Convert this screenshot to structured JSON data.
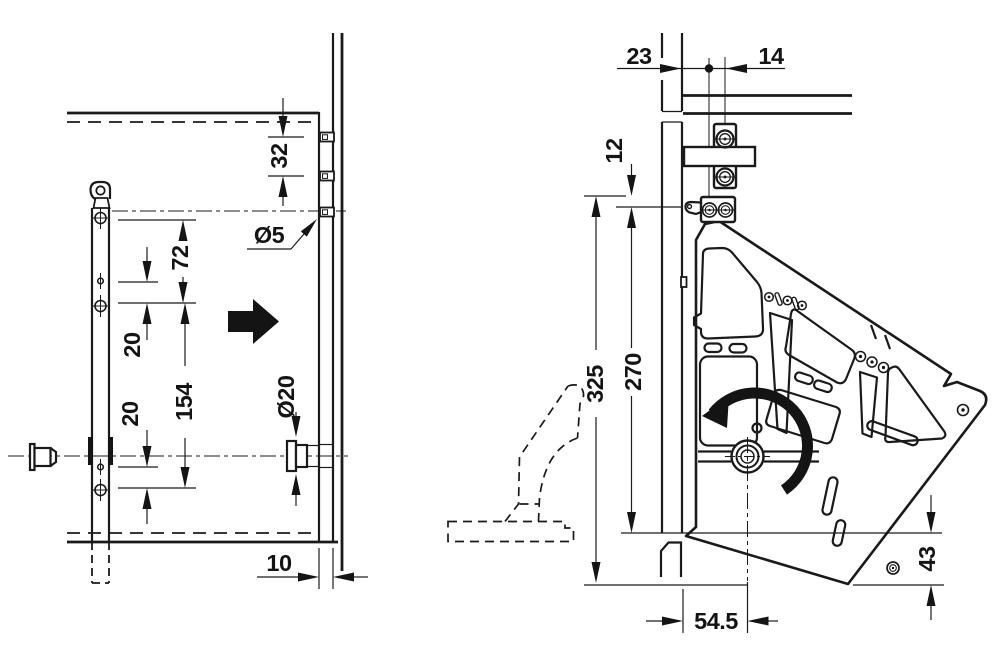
{
  "drawing": {
    "type": "technical-installation-diagram",
    "background": "#ffffff",
    "ink_color": "#1a1a1a",
    "views": {
      "left": {
        "name": "front installation view (mounting rail and drill holes)",
        "dims": {
          "screw_spacing": "32",
          "pilot_hole_dia": "Ø5",
          "hole_top": "72",
          "hole_upper": "20",
          "hole_span": "154",
          "hole_lower": "20",
          "bolt_dia": "Ø20",
          "front_setback": "10"
        }
      },
      "right": {
        "name": "side installation view (pivot lever bracket)",
        "dims": {
          "edge_to_screw": "23",
          "screw_inset": "14",
          "top_offset": "12",
          "total_height": "325",
          "profile_height": "270",
          "pivot_depth": "54.5",
          "bottom_clearance": "43"
        }
      }
    },
    "icons": {
      "rotation": "counterclockwise-arc-arrow",
      "insert_direction": "solid-right-arrow"
    }
  }
}
